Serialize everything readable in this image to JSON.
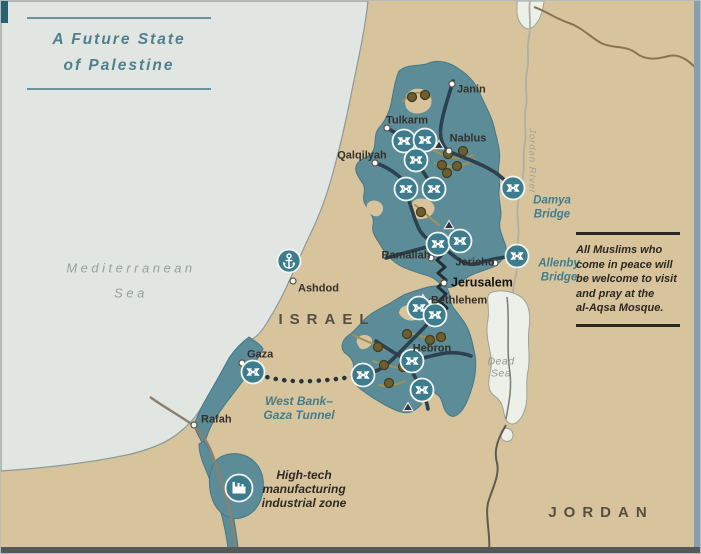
{
  "title": {
    "line1": "A Future State",
    "line2": "of Palestine"
  },
  "quote": {
    "text": "All Muslims who\ncome in peace will\nbe welcome to visit\nand pray at the\nal-Aqsa Mosque."
  },
  "colors": {
    "sea": "#e2e6e3",
    "land": "#d8c49c",
    "palestine_territory": "#5c8c98",
    "dead_sea": "#edefe9",
    "main_road": "#2c4150",
    "secondary_road": "#a29058",
    "accent_teal": "#417d8c",
    "icon_circle": "#3c7c8c",
    "community_dot": "#6d5e2f",
    "border_brown": "#8b7350",
    "river_gray": "#b1afa5"
  },
  "labels": [
    {
      "id": "mediterranean-sea",
      "lines": [
        "Mediterranean",
        "Sea"
      ],
      "x": 130,
      "y": 280,
      "cls": "sea-lbl",
      "anchor": "m"
    },
    {
      "id": "israel",
      "lines": [
        "ISRAEL"
      ],
      "x": 326,
      "y": 319,
      "cls": "country",
      "anchor": "m"
    },
    {
      "id": "jordan",
      "lines": [
        "JORDAN"
      ],
      "x": 600,
      "y": 512,
      "cls": "country",
      "anchor": "m"
    },
    {
      "id": "janin",
      "lines": [
        "Janin"
      ],
      "x": 456,
      "y": 89,
      "cls": "city",
      "anchor": "s"
    },
    {
      "id": "tulkarm",
      "lines": [
        "Tulkarm"
      ],
      "x": 406,
      "y": 120,
      "cls": "city",
      "anchor": "m"
    },
    {
      "id": "nablus",
      "lines": [
        "Nablus"
      ],
      "x": 467,
      "y": 138,
      "cls": "city",
      "anchor": "m"
    },
    {
      "id": "qalqilyah",
      "lines": [
        "Qalqilyah"
      ],
      "x": 361,
      "y": 155,
      "cls": "city",
      "anchor": "m"
    },
    {
      "id": "ramallah",
      "lines": [
        "Ramallah"
      ],
      "x": 405,
      "y": 255,
      "cls": "city",
      "anchor": "m"
    },
    {
      "id": "jericho",
      "lines": [
        "Jericho"
      ],
      "x": 474,
      "y": 262,
      "cls": "city",
      "anchor": "m"
    },
    {
      "id": "jerusalem",
      "lines": [
        "Jerusalem"
      ],
      "x": 450,
      "y": 282,
      "cls": "city-bold",
      "anchor": "s"
    },
    {
      "id": "bethlehem",
      "lines": [
        "Bethlehem"
      ],
      "x": 458,
      "y": 300,
      "cls": "city",
      "anchor": "m"
    },
    {
      "id": "hebron",
      "lines": [
        "Hebron"
      ],
      "x": 431,
      "y": 348,
      "cls": "city",
      "anchor": "m"
    },
    {
      "id": "ashdod",
      "lines": [
        "Ashdod"
      ],
      "x": 297,
      "y": 288,
      "cls": "city",
      "anchor": "s"
    },
    {
      "id": "gaza",
      "lines": [
        "Gaza"
      ],
      "x": 246,
      "y": 354,
      "cls": "city",
      "anchor": "s"
    },
    {
      "id": "rafah",
      "lines": [
        "Rafah"
      ],
      "x": 200,
      "y": 419,
      "cls": "city",
      "anchor": "s"
    },
    {
      "id": "damya-bridge",
      "lines": [
        "Damya",
        "Bridge"
      ],
      "x": 551,
      "y": 207,
      "cls": "bridge",
      "anchor": "m"
    },
    {
      "id": "allenby-bridge",
      "lines": [
        "Allenby",
        "Bridge"
      ],
      "x": 558,
      "y": 270,
      "cls": "bridge",
      "anchor": "m"
    },
    {
      "id": "west-bank-gaza-tunnel",
      "lines": [
        "West Bank–",
        "Gaza Tunnel"
      ],
      "x": 298,
      "y": 407,
      "cls": "feature-teal",
      "anchor": "m"
    },
    {
      "id": "industrial-zone",
      "lines": [
        "High-tech",
        "manufacturing",
        "industrial zone"
      ],
      "x": 303,
      "y": 488,
      "cls": "feature-dark",
      "anchor": "m"
    },
    {
      "id": "dead-sea",
      "lines": [
        "Dead",
        "Sea"
      ],
      "x": 500,
      "y": 367,
      "cls": "water-small",
      "anchor": "m"
    },
    {
      "id": "jordan-river",
      "lines": [
        "Jordan River"
      ],
      "x": 531,
      "y": 160,
      "cls": "river-lbl",
      "anchor": "m",
      "rotate": 90
    }
  ],
  "icons": {
    "crossing_name": "road-crossing-icon",
    "crossings": [
      [
        403,
        140
      ],
      [
        424,
        139
      ],
      [
        415,
        159
      ],
      [
        405,
        188
      ],
      [
        433,
        188
      ],
      [
        437,
        243
      ],
      [
        459,
        240
      ],
      [
        512,
        187
      ],
      [
        516,
        255
      ],
      [
        418,
        307
      ],
      [
        434,
        314
      ],
      [
        411,
        360
      ],
      [
        421,
        389
      ],
      [
        362,
        374
      ],
      [
        252,
        371
      ]
    ],
    "anchor": {
      "name": "anchor-port-icon",
      "x": 288,
      "y": 260
    },
    "factory": {
      "name": "factory-icon",
      "x": 238,
      "y": 487
    }
  },
  "markers": {
    "city_dots": [
      [
        451,
        83
      ],
      [
        386,
        127
      ],
      [
        448,
        150
      ],
      [
        374,
        162
      ],
      [
        430,
        257
      ],
      [
        494,
        262
      ],
      [
        443,
        282
      ],
      [
        430,
        301
      ],
      [
        404,
        355
      ],
      [
        292,
        280
      ],
      [
        241,
        362
      ],
      [
        193,
        424
      ]
    ],
    "communities": [
      [
        411,
        96
      ],
      [
        424,
        94
      ],
      [
        447,
        153
      ],
      [
        462,
        150
      ],
      [
        441,
        164
      ],
      [
        456,
        165
      ],
      [
        446,
        172
      ],
      [
        420,
        211
      ],
      [
        406,
        333
      ],
      [
        429,
        339
      ],
      [
        440,
        336
      ],
      [
        377,
        346
      ],
      [
        383,
        364
      ],
      [
        402,
        366
      ],
      [
        388,
        382
      ]
    ],
    "peaks": [
      [
        438,
        144
      ],
      [
        448,
        224
      ],
      [
        422,
        298
      ],
      [
        407,
        406
      ]
    ]
  }
}
